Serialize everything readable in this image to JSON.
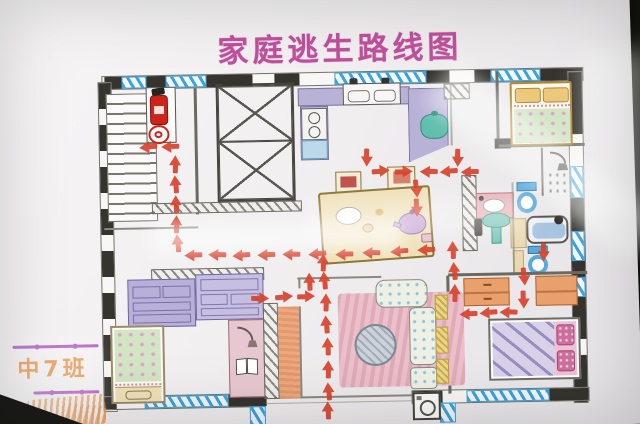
{
  "photo": {
    "background_color": "#23221f",
    "paper_color": "#f1eff0",
    "description": "photograph of a hand-drawn family fire escape route floor plan on white paper"
  },
  "title": {
    "text": "家庭逃生路线图",
    "color": "#c0509c"
  },
  "class_label": {
    "text": "中7班",
    "color": "#e8954e",
    "divider_color": "#b560c4"
  },
  "plan": {
    "colors": {
      "wall": "#35342f",
      "window": "#3ba2dc",
      "route": "#d8432e",
      "counter": "#b9b2d7",
      "cabinet_blue": "#bcd9ea",
      "pot": "#62bfae",
      "table": "#efe0b8",
      "teapot": "#c9a8d4",
      "pillow_yellow": "#ecc87c",
      "blanket_green": "#d2e6c6",
      "dot_pink": "#e39ec6",
      "toilet_blue": "#5aaad9",
      "basin_green": "#7ec8b8",
      "tub_blue": "#a9c4e0",
      "counter_pink": "#e8b0b8",
      "wardrobe_orange": "#e8a06c",
      "blanket_stripe": "#d8d2e8",
      "stripe": "#9a8cc0",
      "pillow_pink": "#cc6f9c",
      "carpet_pink": "#eac0ca",
      "sofa": "#eef0e4",
      "sofa_dot": "#8fc4e2",
      "side_table_yellow": "#ecd684",
      "dresser_purple": "#b8b0d8",
      "desk_pink": "#e8c8d0",
      "strip_orange": "#eda880",
      "footboard_cream": "#f0e2b8",
      "extinguisher_red": "#cc2418"
    },
    "rooms": [
      "stairwell",
      "elevator-shaft",
      "kitchen",
      "dining-area",
      "bedroom-top-right",
      "bathroom",
      "bedroom-bottom-right",
      "living-room",
      "bedroom-bottom-left"
    ],
    "furniture_icons": [
      "stairs",
      "fire-extinguisher-icon",
      "fire-hose-reel-icon",
      "elevator-shaft-cross",
      "kitchen-counter",
      "kitchen-sink",
      "stove-burners",
      "kitchen-cabinet",
      "cooking-pot-icon",
      "dining-table",
      "dining-chair",
      "plate-icon",
      "teapot-icon",
      "bed",
      "pillow",
      "shower-icon",
      "toilet-icon",
      "washbasin-icon",
      "pedestal-sink-icon",
      "bathtub-icon",
      "floor-tiles",
      "wardrobe",
      "carpet",
      "round-rug",
      "sofa",
      "side-table",
      "washing-machine-icon",
      "dresser",
      "desk",
      "desk-lamp-icon",
      "open-book-icon",
      "window-hatch",
      "escape-route-arrow"
    ],
    "arrows": [
      {
        "x": 150,
        "y": 144,
        "dir": "left"
      },
      {
        "x": 172,
        "y": 144,
        "dir": "left"
      },
      {
        "x": 176,
        "y": 162,
        "dir": "up"
      },
      {
        "x": 176,
        "y": 182,
        "dir": "up"
      },
      {
        "x": 176,
        "y": 202,
        "dir": "up"
      },
      {
        "x": 176,
        "y": 222,
        "dir": "up"
      },
      {
        "x": 177,
        "y": 241,
        "dir": "up"
      },
      {
        "x": 193,
        "y": 253,
        "dir": "left"
      },
      {
        "x": 217,
        "y": 253,
        "dir": "left"
      },
      {
        "x": 241,
        "y": 254,
        "dir": "left"
      },
      {
        "x": 266,
        "y": 254,
        "dir": "left"
      },
      {
        "x": 291,
        "y": 254,
        "dir": "left"
      },
      {
        "x": 317,
        "y": 254,
        "dir": "left"
      },
      {
        "x": 344,
        "y": 255,
        "dir": "left"
      },
      {
        "x": 371,
        "y": 254,
        "dir": "left"
      },
      {
        "x": 399,
        "y": 253,
        "dir": "left"
      },
      {
        "x": 426,
        "y": 252,
        "dir": "left"
      },
      {
        "x": 368,
        "y": 158,
        "dir": "down"
      },
      {
        "x": 381,
        "y": 172,
        "dir": "right"
      },
      {
        "x": 404,
        "y": 173,
        "dir": "right"
      },
      {
        "x": 430,
        "y": 174,
        "dir": "left"
      },
      {
        "x": 450,
        "y": 174,
        "dir": "left"
      },
      {
        "x": 471,
        "y": 175,
        "dir": "left"
      },
      {
        "x": 459,
        "y": 160,
        "dir": "down"
      },
      {
        "x": 417,
        "y": 190,
        "dir": "down"
      },
      {
        "x": 417,
        "y": 209,
        "dir": "down"
      },
      {
        "x": 322,
        "y": 263,
        "dir": "up"
      },
      {
        "x": 323,
        "y": 281,
        "dir": "up"
      },
      {
        "x": 308,
        "y": 282,
        "dir": "up"
      },
      {
        "x": 324,
        "y": 303,
        "dir": "up"
      },
      {
        "x": 324,
        "y": 325,
        "dir": "up"
      },
      {
        "x": 325,
        "y": 347,
        "dir": "up"
      },
      {
        "x": 325,
        "y": 370,
        "dir": "up"
      },
      {
        "x": 325,
        "y": 392,
        "dir": "up"
      },
      {
        "x": 324,
        "y": 411,
        "dir": "up"
      },
      {
        "x": 258,
        "y": 297,
        "dir": "right"
      },
      {
        "x": 282,
        "y": 296,
        "dir": "right"
      },
      {
        "x": 304,
        "y": 296,
        "dir": "right"
      },
      {
        "x": 543,
        "y": 256,
        "dir": "down"
      },
      {
        "x": 523,
        "y": 280,
        "dir": "down"
      },
      {
        "x": 522,
        "y": 303,
        "dir": "down"
      },
      {
        "x": 507,
        "y": 316,
        "dir": "left"
      },
      {
        "x": 487,
        "y": 316,
        "dir": "left"
      },
      {
        "x": 467,
        "y": 317,
        "dir": "left"
      },
      {
        "x": 453,
        "y": 296,
        "dir": "up"
      },
      {
        "x": 453,
        "y": 274,
        "dir": "up"
      },
      {
        "x": 452,
        "y": 253,
        "dir": "up"
      }
    ]
  }
}
